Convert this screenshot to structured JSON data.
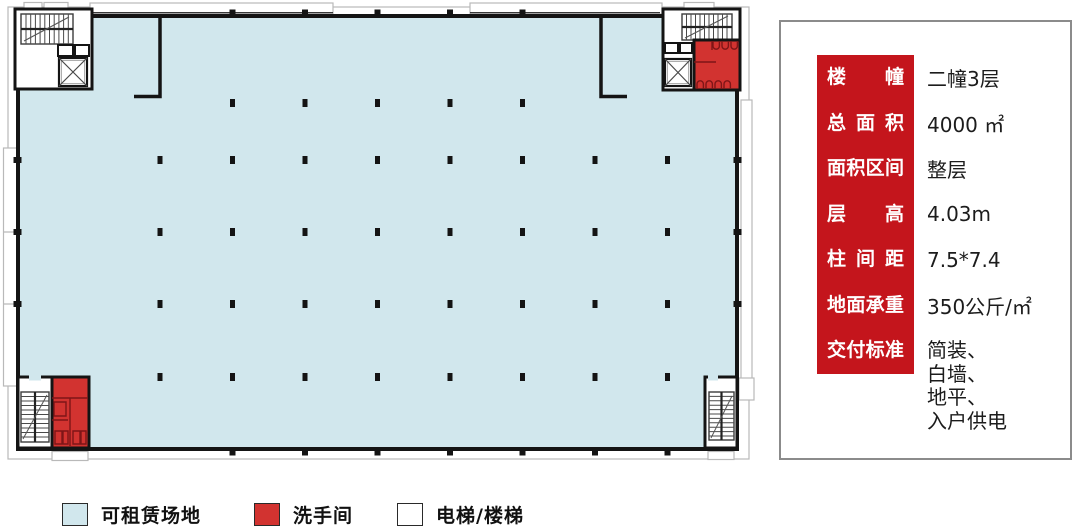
{
  "floor_plan": {
    "colors": {
      "floor": "#d1e7ed",
      "wall": "#141414",
      "restroom": "#d23330",
      "outline": "#b9b9b9",
      "fixture": "#7e1517"
    },
    "grid": {
      "column_xs": [
        160,
        232.5,
        305,
        377.5,
        450,
        522.5,
        595,
        667.5
      ],
      "rows": [
        {
          "y": 103,
          "start": 1,
          "end": 5
        },
        {
          "y": 160,
          "start": 0,
          "end": 7
        },
        {
          "y": 232,
          "start": 0,
          "end": 7
        },
        {
          "y": 304,
          "start": 0,
          "end": 7
        },
        {
          "y": 377,
          "start": 0,
          "end": 7
        }
      ],
      "top_stub_xs": [
        232.5,
        305,
        377.5,
        450,
        522.5
      ],
      "bottom_stub_xs": [
        232.5,
        305,
        377.5,
        450,
        522.5,
        595,
        667.5
      ],
      "side_stub_ys": [
        160,
        232,
        304
      ]
    }
  },
  "legend": {
    "items": [
      {
        "label": "可租赁场地",
        "color": "#d1e7ed"
      },
      {
        "label": "洗手间",
        "color": "#d23330"
      },
      {
        "label": "电梯/楼梯",
        "color": "#ffffff"
      }
    ]
  },
  "panel": {
    "accent_color": "#c4151c",
    "rows": [
      {
        "label": "楼幢",
        "value": "二幢3层"
      },
      {
        "label": "总面积",
        "value": "4000 ㎡"
      },
      {
        "label": "面积区间",
        "value": "整层"
      },
      {
        "label": "层高",
        "value": "4.03m"
      },
      {
        "label": "柱间距",
        "value": "7.5*7.4"
      },
      {
        "label": "地面承重",
        "value": "350公斤/㎡"
      },
      {
        "label": "交付标准",
        "value": "简装、\n白墙、\n地平、\n入户供电"
      }
    ]
  }
}
